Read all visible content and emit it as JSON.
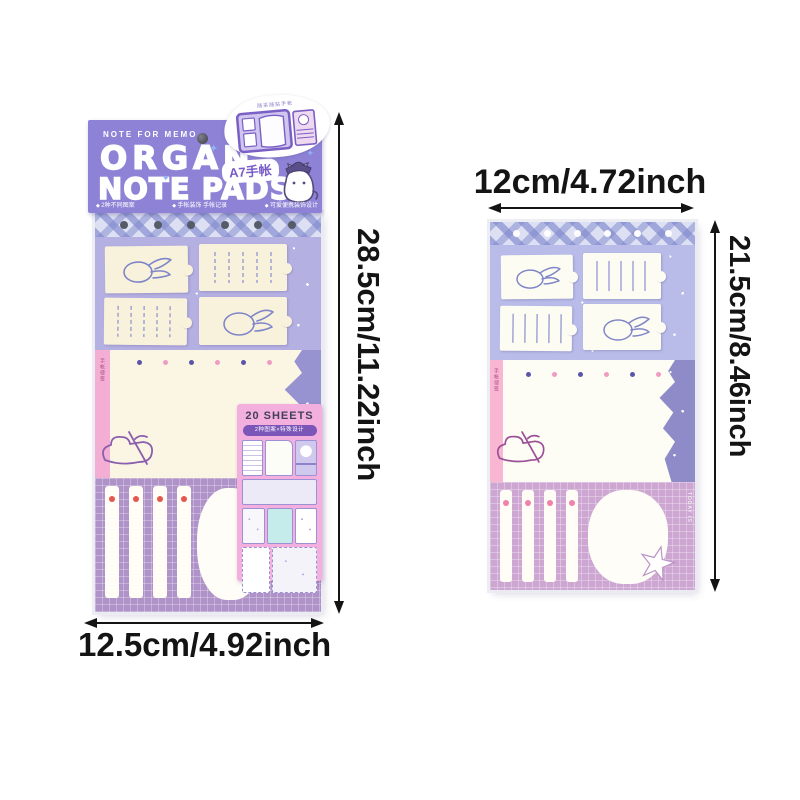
{
  "measurements": {
    "left_height": "28.5cm/11.22inch",
    "left_width": "12.5cm/4.92inch",
    "right_width": "12cm/4.72inch",
    "right_height": "21.5cm/8.46inch"
  },
  "package_header": {
    "tagline": "NOTE FOR MEMO",
    "title_line1": "ORGAN",
    "title_line2": "NOTE PADS",
    "badge": "A7手帐",
    "features": [
      "2种不同图案",
      "手帐装饰 手帐记录",
      "可爱便携装饰设计"
    ]
  },
  "sticker": {
    "caption": "随采随贴手帐"
  },
  "label_card": {
    "sheets_count": "20 SHEETS",
    "pill_text": "2种图案×特殊设计"
  },
  "pad_details": {
    "left_side_text": "手帐便签",
    "right_side_text": "TODAY IS"
  },
  "colors": {
    "header_purple": "#8d82d6",
    "lavender_panel": "#b5b0e2",
    "deep_lavender": "#9793d0",
    "plaid_blue": "#dde0f3",
    "cream": "#f8f2dc",
    "pink_strip": "#f4aed3",
    "mauve_bottom": "#ae92c8",
    "pink_card": "#f3b0de",
    "pill_purple": "#7c55b8",
    "dot_red": "#e4574d",
    "dot_pink": "#ee82ad",
    "annotation_black": "#141414"
  }
}
